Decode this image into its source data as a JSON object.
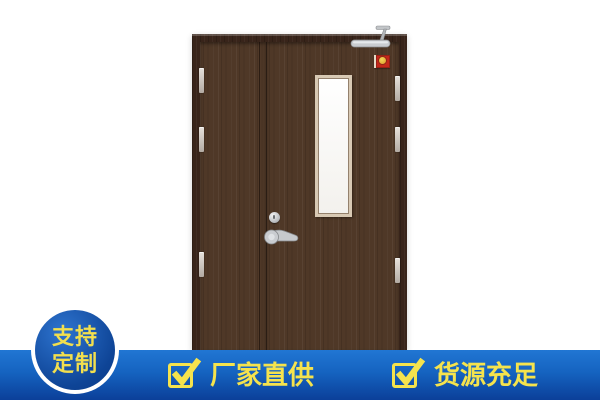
{
  "badge": {
    "line1": "支持",
    "line2": "定制",
    "bg_color": "#0e4496",
    "text_color": "#f2df4e",
    "ring_color": "#ffffff"
  },
  "banner": {
    "items": [
      {
        "label": "厂家直供"
      },
      {
        "label": "货源充足"
      }
    ],
    "text_color": "#f5e34d",
    "check_color": "#f5e34d",
    "bg_top": "#2176d3",
    "bg_bottom": "#0b3f99"
  },
  "door": {
    "frame_color": "#38241a",
    "panel_color": "#4f3827",
    "glass_color": "#ffffff",
    "hardware_color": "#c6c9cc",
    "fire_sign_color": "#c4271b"
  }
}
